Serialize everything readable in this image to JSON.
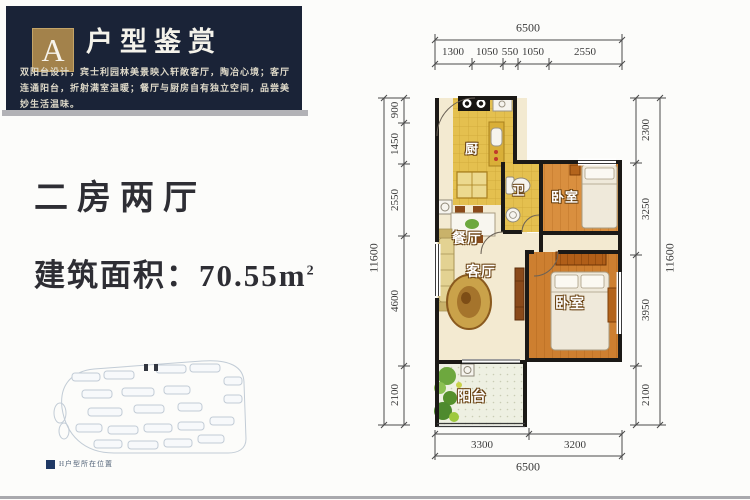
{
  "header": {
    "badge_letter": "A",
    "title": "户型鉴赏",
    "description": "双阳台设计，宾士利园林美景映入轩敞客厅，陶冶心境；客厅连通阳台，折射满室温暖；餐厅与厨房自有独立空间，品尝美妙生活温味。"
  },
  "info": {
    "layout_type": "二房两厅",
    "area_label": "建筑面积：",
    "area_value": "70.55m",
    "area_superscript": "2"
  },
  "floorplan": {
    "rooms": {
      "kitchen": "厨",
      "bathroom": "卫",
      "bedroom_top": "卧室",
      "dining": "餐厅",
      "living": "客厅",
      "bedroom_bottom": "卧室",
      "balcony": "阳台"
    },
    "dimensions": {
      "top": {
        "total": "6500",
        "segments": [
          "1300",
          "1050",
          "550",
          "1050",
          "2550"
        ]
      },
      "bottom": {
        "total": "6500",
        "segments": [
          "3300",
          "3200"
        ]
      },
      "left": {
        "total": "11600",
        "segments": [
          "900",
          "1450",
          "2550",
          "4600",
          "2100"
        ]
      },
      "right": {
        "total": "11600",
        "segments": [
          "2300",
          "3250",
          "3950",
          "2100"
        ]
      }
    }
  },
  "siteplan": {
    "legend_label": "H户型所在位置"
  },
  "colors": {
    "header_bg": "#1a2337",
    "badge_gold": "#a3824b",
    "wall_black": "#1b1916",
    "tile_yellow": "#e4c04f",
    "wood_orange": "#d08334",
    "floor_cream": "#f3ead1",
    "legend_navy": "#1f3864"
  }
}
